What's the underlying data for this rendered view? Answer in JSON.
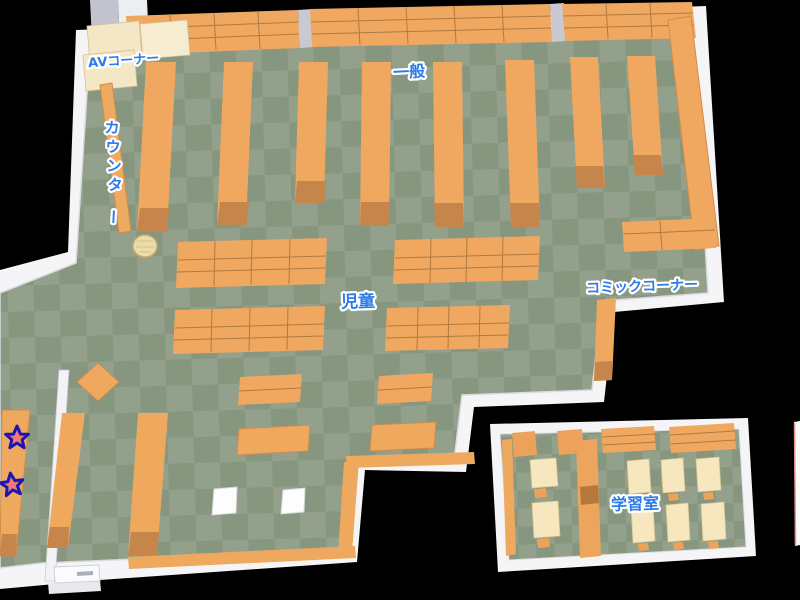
{
  "map": {
    "type": "library-floor-map",
    "labels": {
      "av_corner": "AVコーナー",
      "general": "一般",
      "counter": "カウンター",
      "children": "児童",
      "comic_corner": "コミックコーナー",
      "study_room": "学習室"
    },
    "counter_chars": [
      "カ",
      "ウ",
      "ン",
      "タ",
      "ー"
    ],
    "markers": {
      "star_count": 2,
      "star_icon": "star"
    },
    "colors": {
      "background": "#000000",
      "wall": "#f5f5f7",
      "floor_light": "#93a08b",
      "floor_dark": "#86967f",
      "shelf_orange": "#f0a860",
      "shelf_front": "#c6854b",
      "desk_cream": "#f6e7be",
      "av_shelf_cream": "#f3e7c6",
      "label_blue": "#2b7bea",
      "label_outline": "#ffffff",
      "star_fill": "#f47878",
      "star_outline": "#1a16b4"
    }
  }
}
